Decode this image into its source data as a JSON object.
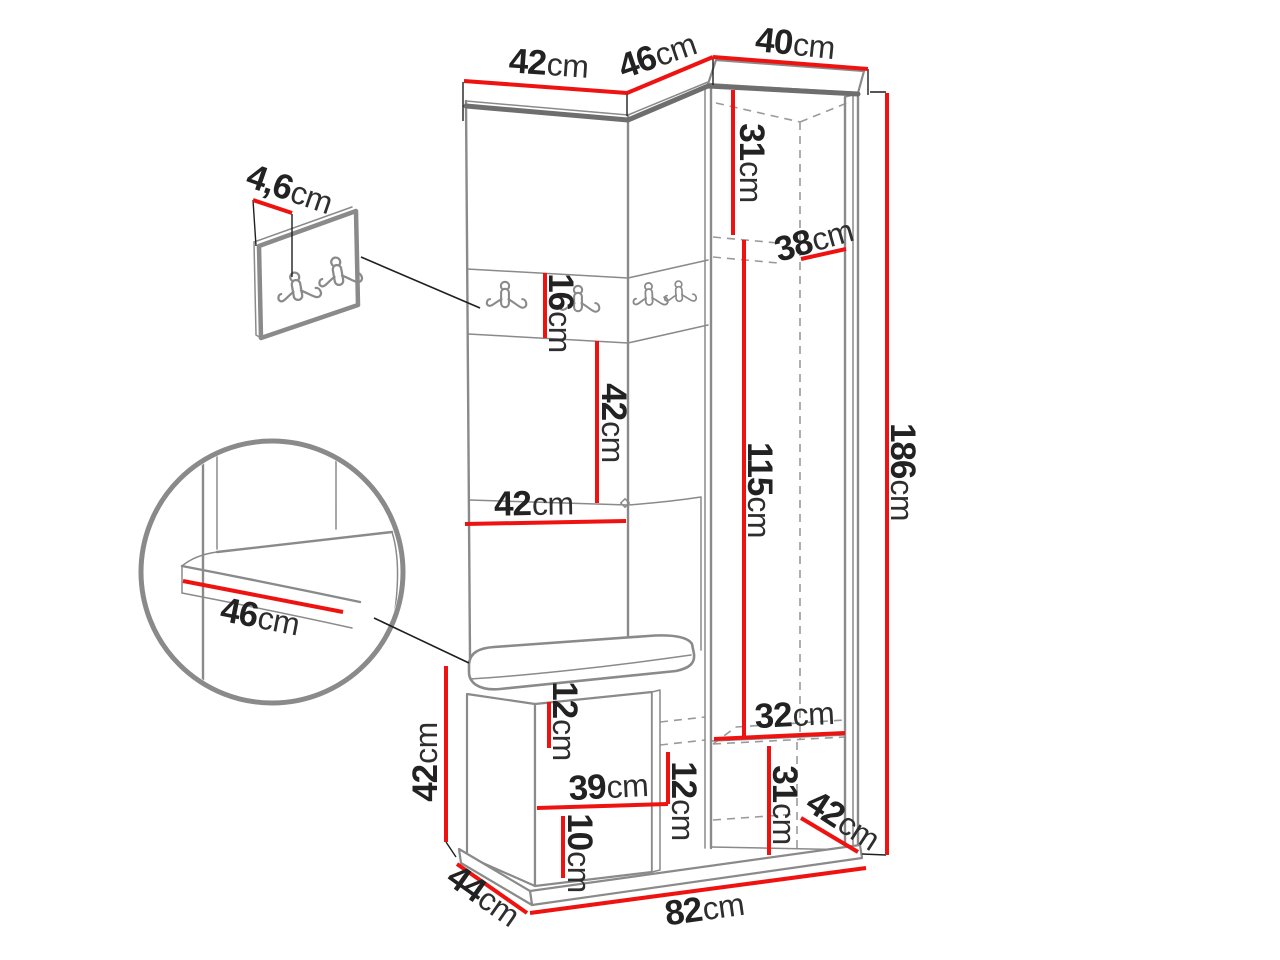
{
  "colors": {
    "dimension-line": "#ee1310",
    "outline": "#8a8a8a",
    "outline-dark": "#6e6e6e",
    "ink": "#1f1f1f",
    "background": "#ffffff",
    "text": "#222222"
  },
  "icons": {
    "coat_hook": "double-coat-hook"
  },
  "dimensions": {
    "top_left_width": {
      "value": "42",
      "unit": "cm"
    },
    "top_angled_width": {
      "value": "46",
      "unit": "cm"
    },
    "top_cabinet_width": {
      "value": "40",
      "unit": "cm"
    },
    "wall_panel_thickness": {
      "value": "4,6",
      "unit": "cm"
    },
    "cabinet_upper_height": {
      "value": "31",
      "unit": "cm"
    },
    "cabinet_inner_width": {
      "value": "38",
      "unit": "cm"
    },
    "hook_strip_height": {
      "value": "16",
      "unit": "cm"
    },
    "backrest_height": {
      "value": "42",
      "unit": "cm"
    },
    "seat_depth": {
      "value": "42",
      "unit": "cm"
    },
    "seat_detail_width": {
      "value": "46",
      "unit": "cm"
    },
    "cabinet_door_height": {
      "value": "115",
      "unit": "cm"
    },
    "total_height": {
      "value": "186",
      "unit": "cm"
    },
    "bench_height": {
      "value": "42",
      "unit": "cm"
    },
    "bench_top_clearance": {
      "value": "12",
      "unit": "cm"
    },
    "bench_inner_width": {
      "value": "39",
      "unit": "cm"
    },
    "bench_shelf_spacing": {
      "value": "12",
      "unit": "cm"
    },
    "bench_bottom_clearance": {
      "value": "10",
      "unit": "cm"
    },
    "cabinet_lower_width": {
      "value": "32",
      "unit": "cm"
    },
    "cabinet_lower_height": {
      "value": "31",
      "unit": "cm"
    },
    "cabinet_lower_diagonal": {
      "value": "42",
      "unit": "cm"
    },
    "base_depth": {
      "value": "44",
      "unit": "cm"
    },
    "base_width": {
      "value": "82",
      "unit": "cm"
    }
  }
}
